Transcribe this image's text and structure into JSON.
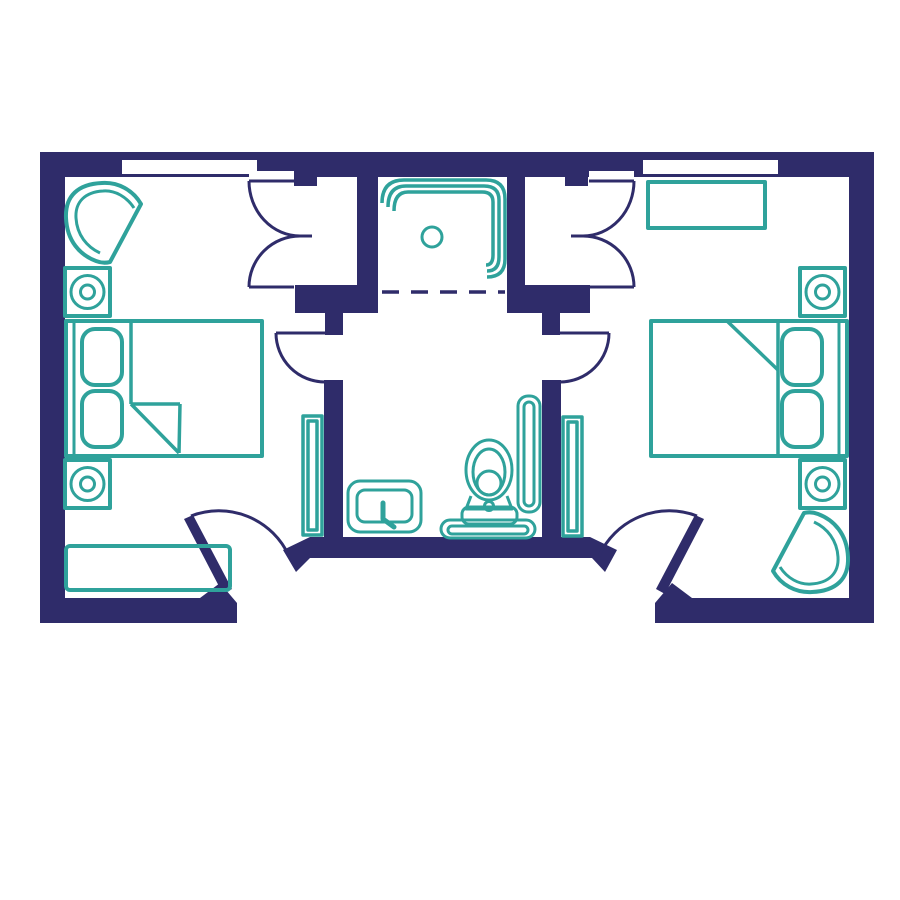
{
  "title": "Two-bedroom suite floor plan",
  "colors": {
    "wall": "#2f2c6a",
    "door_line": "#2f2c6a",
    "furniture": "#2fa29b",
    "floor": "#ffffff"
  },
  "rooms": [
    {
      "name": "left-bedroom",
      "features": [
        "window",
        "corner-armchair",
        "speaker-nightstand-top",
        "double-bed",
        "speaker-nightstand-bottom",
        "radiator",
        "bench",
        "entry-door",
        "closet-double-doors",
        "bathroom-door"
      ]
    },
    {
      "name": "closet-shower",
      "features": [
        "shower-tub-enclosure",
        "floor-drain",
        "dashed-threshold"
      ]
    },
    {
      "name": "bathroom",
      "features": [
        "sink-vanity",
        "toilet",
        "towel-radiator",
        "door-to-left-bedroom",
        "door-to-right-bedroom"
      ]
    },
    {
      "name": "right-bedroom",
      "features": [
        "window",
        "dresser",
        "speaker-nightstand-top",
        "double-bed",
        "speaker-nightstand-bottom",
        "radiator",
        "corner-armchair",
        "entry-door",
        "closet-double-doors",
        "bathroom-door"
      ]
    }
  ],
  "counts": {
    "windows": 2,
    "beds": 2,
    "pillows_per_bed": 2,
    "speaker_nightstands": 4,
    "entry_doors": 2,
    "closet_door_sets": 2,
    "bathroom_doors": 2,
    "radiators": 2,
    "armchairs": 2
  }
}
